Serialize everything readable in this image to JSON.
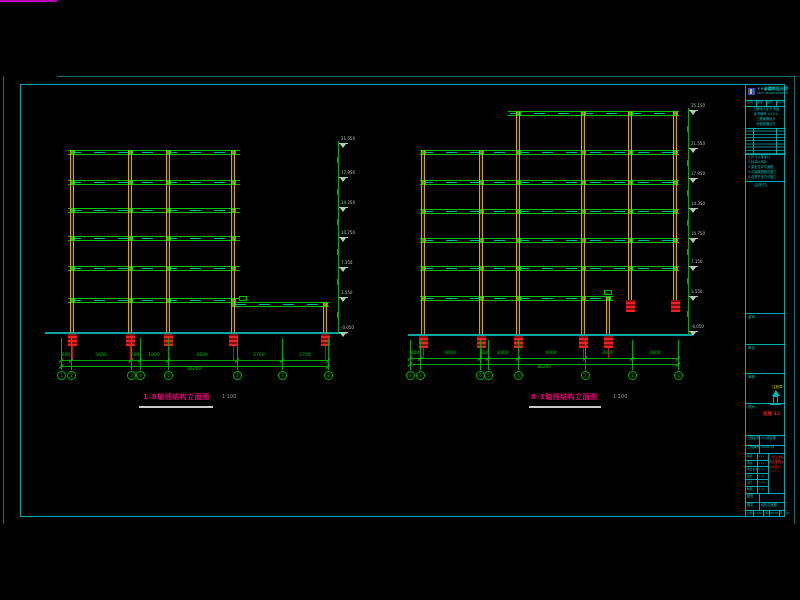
{
  "sheet": {
    "background": "#010101",
    "frame": {
      "outer_color": "#176b6b",
      "inner_color": "#00adad",
      "magenta_color": "#b800b8",
      "inner": {
        "x": 20,
        "y": 84,
        "w": 765,
        "h": 433
      }
    }
  },
  "title_block": {
    "institute": "××省建筑设计院",
    "institute_en": "ARCH DESIGN INSTITUTE",
    "cert_cells": [
      "证书",
      "甲级",
      "编号",
      "A103"
    ],
    "cred_lines": [
      "工程设计证书 甲级",
      "证书编号 ××××",
      "工程勘察设计",
      "收费资格证书"
    ],
    "rev_note": "(会签栏)",
    "notes": [
      "1.尺寸以毫米计",
      "2.标高以米计",
      "3.梁定位详平面图",
      "4.与建筑图配合施工",
      "5.会签齐全方可施工"
    ],
    "sig_cells": [
      "会审",
      "审定",
      "审核",
      "校对"
    ],
    "info_rows": [
      [
        "工程名称",
        "××综合楼"
      ],
      [
        "工程编号",
        "2008-15"
      ]
    ],
    "staff": [
      [
        "审定",
        "×××"
      ],
      [
        "审核",
        "×××"
      ],
      [
        "专业负责",
        "×××"
      ],
      [
        "校对",
        "×××"
      ],
      [
        "设计",
        "×××"
      ],
      [
        "制图",
        "×××"
      ]
    ],
    "stamp_lines": [
      "一级注册结构工程师",
      "执业专用章",
      "有效期至××××"
    ],
    "stamp_note": "注册章",
    "type_row": [
      "图别",
      "结施"
    ],
    "drawing_no": "结施-12",
    "name_row": [
      "图名",
      "结构立面图"
    ],
    "bottom_cells": [
      [
        "比例",
        "1:100"
      ],
      [
        "日期",
        "08.06"
      ],
      [
        "页",
        "12"
      ]
    ]
  },
  "drawing": {
    "colors": {
      "beam": "#00c400",
      "beam_fill": "#00b3b3",
      "column": "#d2aa00",
      "foundation": "#cf1010",
      "dim": "#00a800",
      "ground": "#00a6a6",
      "level": "#9fbf9f",
      "title": "#e6007a",
      "underline": "#c9c9c9"
    },
    "elevations": [
      {
        "id": "left",
        "title": "1-8轴线结构立面图",
        "scale": "1:100",
        "title_pos": {
          "tx": 143,
          "ty": 394,
          "ux1": 139,
          "ux2": 213,
          "uy": 406,
          "sx": 222,
          "sy": 395
        },
        "ground": {
          "x1": 45,
          "x2": 347,
          "y": 332
        },
        "beams": [
          [
            68,
            240,
            150
          ],
          [
            68,
            240,
            180
          ],
          [
            68,
            240,
            208
          ],
          [
            68,
            240,
            236
          ],
          [
            68,
            240,
            266
          ],
          [
            68,
            240,
            298
          ],
          [
            233,
            329,
            302
          ]
        ],
        "columns": [
          [
            72,
            150,
            333
          ],
          [
            130,
            150,
            333
          ],
          [
            168,
            150,
            333
          ],
          [
            233,
            150,
            333
          ],
          [
            325,
            303,
            333
          ]
        ],
        "foundations": [
          [
            72,
            334
          ],
          [
            130,
            334
          ],
          [
            168,
            334
          ],
          [
            233,
            334
          ],
          [
            325,
            334
          ]
        ],
        "found_ext": {
          "xs": [
            72,
            130,
            168,
            233,
            325
          ],
          "y1": 346,
          "y2": 360
        },
        "grid_ext": {
          "y1": 338,
          "y2": 370
        },
        "dims": {
          "y1": 360,
          "y2": 366,
          "x1": 61,
          "x2": 328,
          "segments": [
            [
              66,
              "600"
            ],
            [
              101,
              "3600"
            ],
            [
              135,
              "600"
            ],
            [
              154,
              "1800"
            ],
            [
              202,
              "4200"
            ],
            [
              259,
              "2700"
            ],
            [
              305,
              "2700"
            ]
          ],
          "total": [
            194,
            "16200"
          ]
        },
        "bubbles": {
          "cy": 375,
          "items": [
            [
              61,
              "1"
            ],
            [
              71,
              "2"
            ],
            [
              131,
              "3"
            ],
            [
              140,
              "4"
            ],
            [
              168,
              "5"
            ],
            [
              237,
              "6"
            ],
            [
              282,
              "7"
            ],
            [
              328,
              "8"
            ]
          ]
        },
        "levels": {
          "x": 338,
          "y1": 141,
          "y2": 333,
          "ticks": [
            [
              143,
              "21.550"
            ],
            [
              177,
              "17.950"
            ],
            [
              207,
              "14.350"
            ],
            [
              237,
              "10.750"
            ],
            [
              267,
              "7.150"
            ],
            [
              297,
              "3.550"
            ],
            [
              332,
              "-0.050"
            ]
          ]
        },
        "tags": [
          [
            239,
            296
          ]
        ]
      },
      {
        "id": "right",
        "title": "8-1轴线结构立面图",
        "scale": "1:100",
        "title_pos": {
          "tx": 531,
          "ty": 394,
          "ux1": 529,
          "ux2": 601,
          "uy": 406,
          "sx": 613,
          "sy": 395
        },
        "ground": {
          "x1": 408,
          "x2": 692,
          "y": 334
        },
        "beams": [
          [
            508,
            679,
            111
          ],
          [
            420,
            679,
            150
          ],
          [
            420,
            679,
            180
          ],
          [
            420,
            679,
            209
          ],
          [
            420,
            679,
            238
          ],
          [
            420,
            679,
            266
          ],
          [
            420,
            613,
            296
          ]
        ],
        "columns": [
          [
            423,
            150,
            334
          ],
          [
            481,
            150,
            334
          ],
          [
            518,
            111,
            334
          ],
          [
            583,
            111,
            334
          ],
          [
            630,
            111,
            300
          ],
          [
            675,
            111,
            300
          ],
          [
            608,
            297,
            334
          ]
        ],
        "foundations": [
          [
            423,
            336
          ],
          [
            481,
            336
          ],
          [
            518,
            336
          ],
          [
            583,
            336
          ],
          [
            608,
            336
          ],
          [
            630,
            300
          ],
          [
            675,
            300
          ]
        ],
        "found_ext": {
          "xs": [
            423,
            481,
            518,
            583,
            608
          ],
          "y1": 348,
          "y2": 358
        },
        "grid_ext": {
          "y1": 340,
          "y2": 370
        },
        "dims": {
          "y1": 358,
          "y2": 364,
          "x1": 410,
          "x2": 678,
          "segments": [
            [
              415,
              "600"
            ],
            [
              450,
              "3600"
            ],
            [
              484,
              "600"
            ],
            [
              503,
              "1800"
            ],
            [
              551,
              "4000"
            ],
            [
              608,
              "2800"
            ],
            [
              655,
              "2800"
            ]
          ],
          "total": [
            544,
            "16200"
          ]
        },
        "bubbles": {
          "cy": 375,
          "items": [
            [
              410,
              "8"
            ],
            [
              420,
              "7"
            ],
            [
              480,
              "6"
            ],
            [
              488,
              "5"
            ],
            [
              518,
              "4"
            ],
            [
              585,
              "3"
            ],
            [
              632,
              "2"
            ],
            [
              678,
              "1"
            ]
          ]
        },
        "levels": {
          "x": 688,
          "y1": 108,
          "y2": 334,
          "ticks": [
            [
              110,
              "25.150"
            ],
            [
              148,
              "21.550"
            ],
            [
              178,
              "17.950"
            ],
            [
              208,
              "14.350"
            ],
            [
              238,
              "10.750"
            ],
            [
              266,
              "7.150"
            ],
            [
              296,
              "3.550"
            ],
            [
              331,
              "-0.050"
            ]
          ]
        },
        "tags": [
          [
            604,
            290
          ]
        ]
      }
    ]
  }
}
